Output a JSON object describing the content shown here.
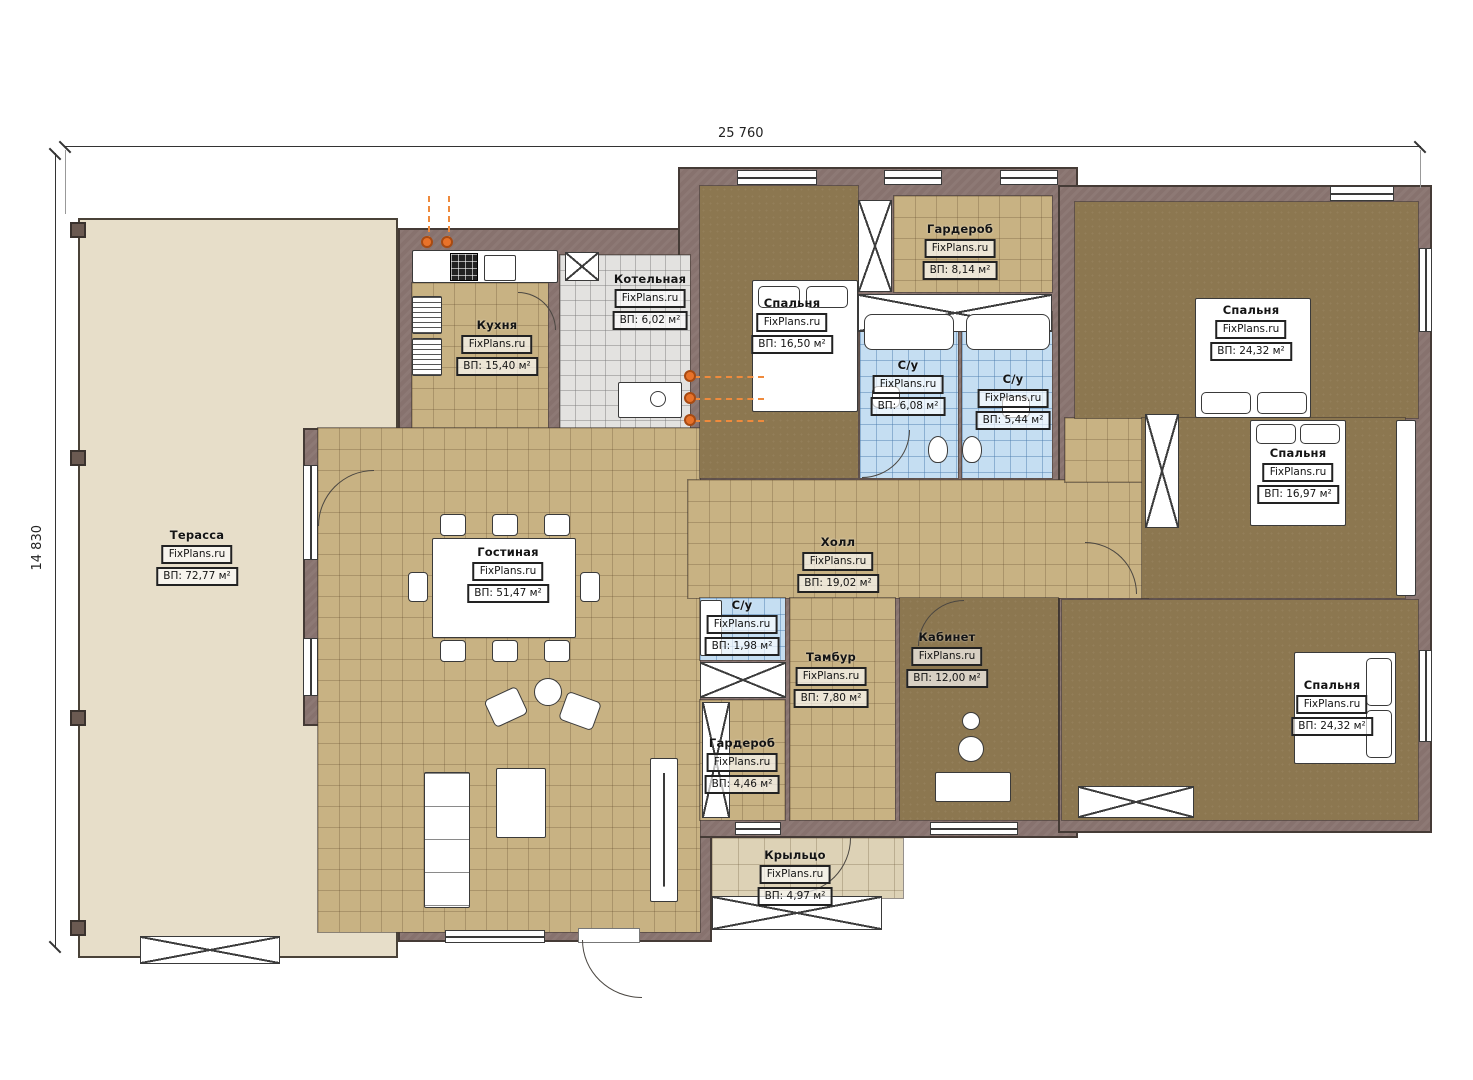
{
  "meta": {
    "watermark": "FixPlans.ru",
    "dim_width": "25 760",
    "dim_height": "14 830"
  },
  "rooms": [
    {
      "id": "terrace",
      "name": "Терасса",
      "area": "ВП: 72,77 м²"
    },
    {
      "id": "kitchen",
      "name": "Кухня",
      "area": "ВП: 15,40 м²"
    },
    {
      "id": "boiler",
      "name": "Котельная",
      "area": "ВП: 6,02 м²"
    },
    {
      "id": "bedroom-1",
      "name": "Спальня",
      "area": "ВП: 16,50 м²"
    },
    {
      "id": "wardrobe-top",
      "name": "Гардероб",
      "area": "ВП: 8,14 м²"
    },
    {
      "id": "wc-left",
      "name": "С/у",
      "area": "ВП: 6,08 м²"
    },
    {
      "id": "wc-right",
      "name": "С/у",
      "area": "ВП: 5,44 м²"
    },
    {
      "id": "bedroom-2",
      "name": "Спальня",
      "area": "ВП: 24,32 м²"
    },
    {
      "id": "bedroom-3",
      "name": "Спальня",
      "area": "ВП: 16,97 м²"
    },
    {
      "id": "living",
      "name": "Гостиная",
      "area": "ВП: 51,47 м²"
    },
    {
      "id": "hall",
      "name": "Холл",
      "area": "ВП: 19,02 м²"
    },
    {
      "id": "wc-small",
      "name": "С/у",
      "area": "ВП: 1,98 м²"
    },
    {
      "id": "tambur",
      "name": "Тамбур",
      "area": "ВП: 7,80 м²"
    },
    {
      "id": "office",
      "name": "Кабинет",
      "area": "ВП: 12,00 м²"
    },
    {
      "id": "wardrobe-bottom",
      "name": "Гардероб",
      "area": "ВП: 4,46 м²"
    },
    {
      "id": "bedroom-4",
      "name": "Спальня",
      "area": "ВП: 24,32 м²"
    },
    {
      "id": "porch",
      "name": "Крыльцо",
      "area": "ВП: 4,97 м²"
    }
  ],
  "colors": {
    "wall": "#87726e",
    "floor_tan": "#c8b283",
    "floor_dark": "#8c7750",
    "tile_blue": "#c5def2",
    "tile_gray": "#e3e2e0",
    "terrace": "#e7dec9",
    "accent_orange": "#e8722a"
  }
}
